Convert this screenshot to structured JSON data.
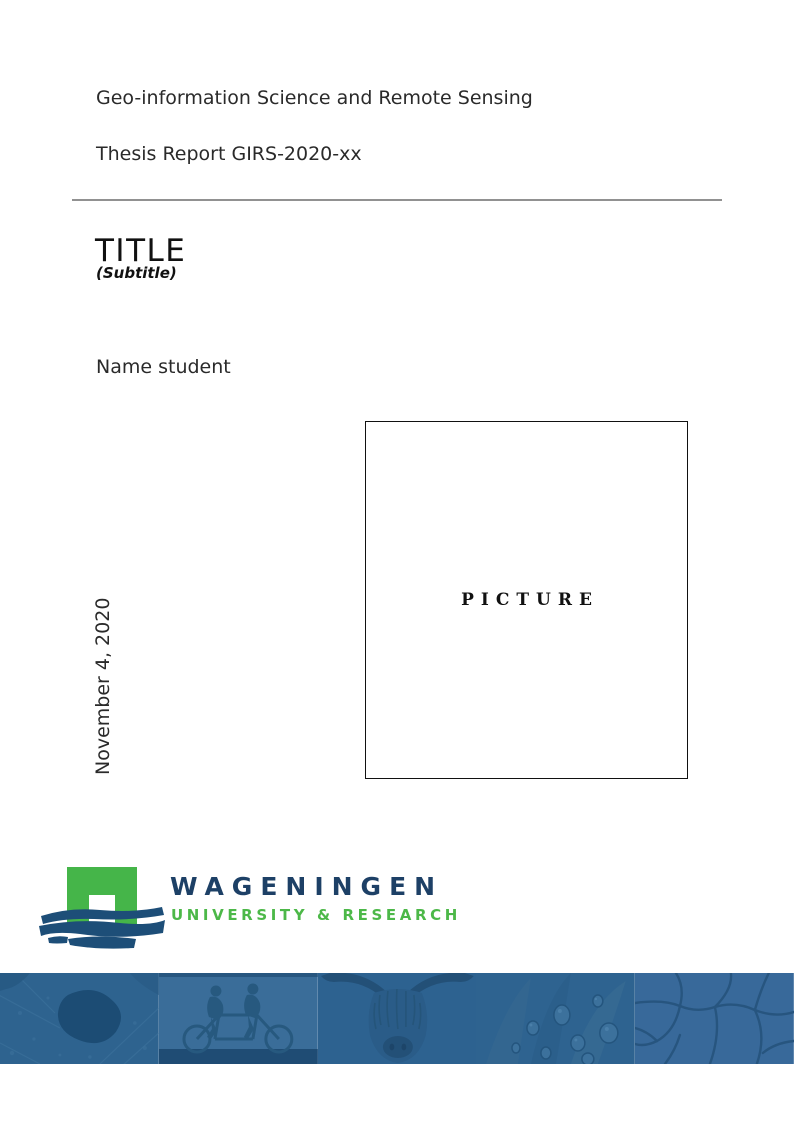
{
  "document": {
    "program": "Geo-information Science and Remote Sensing",
    "report_id": "Thesis Report GIRS-2020-xx",
    "title": "TITLE",
    "subtitle": "(Subtitle)",
    "author": "Name student",
    "date": "November 4, 2020",
    "picture_placeholder": "PICTURE"
  },
  "logo": {
    "wordmark": "WAGENINGEN",
    "tagline": "UNIVERSITY & RESEARCH",
    "colors": {
      "arch_green": "#45b549",
      "brush_navy": "#1d4e78",
      "wordmark_navy": "#1d4066",
      "tagline_green": "#4cb848"
    }
  },
  "banner": {
    "panels": [
      {
        "name": "aerial-map"
      },
      {
        "name": "tandem-cyclists"
      },
      {
        "name": "highland-cow"
      },
      {
        "name": "leaf-droplets"
      },
      {
        "name": "cracked-earth"
      }
    ],
    "colors": {
      "base_blue": "#31648f",
      "light_blue": "#3a6d99",
      "dark_blue": "#24557e",
      "silhouette_blue": "#27597f"
    }
  }
}
